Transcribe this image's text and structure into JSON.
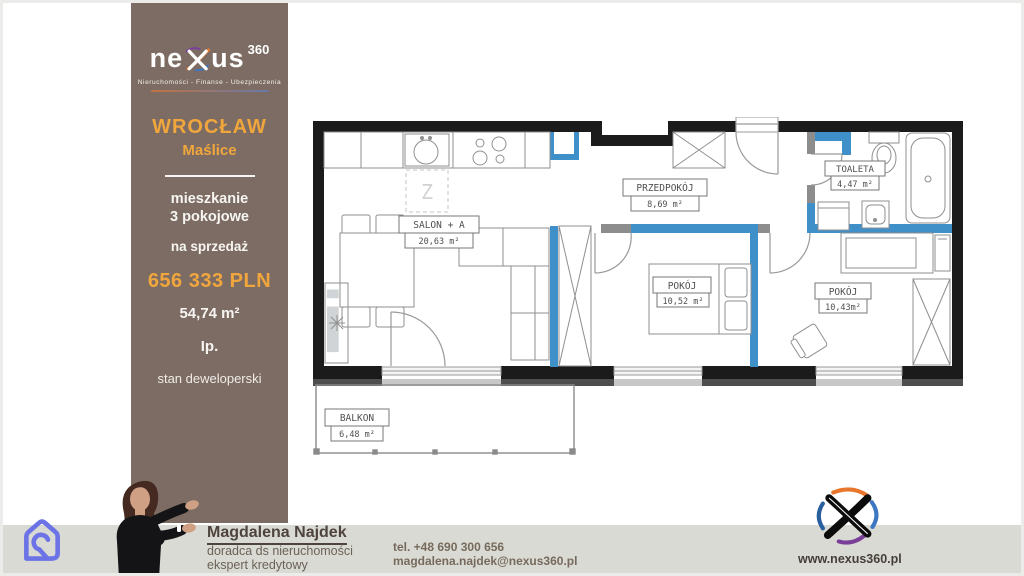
{
  "sidebar": {
    "logo": {
      "word_left": "ne",
      "word_right": "us",
      "sup": "360",
      "tagline": "Nieruchomości - Finanse - Ubezpieczenia"
    },
    "city": "WROCŁAW",
    "district": "Maślice",
    "type_line1": "mieszkanie",
    "type_line2": "3 pokojowe",
    "offer": "na sprzedaż",
    "price": "656 333 PLN",
    "area": "54,74 m²",
    "floor": "Ip.",
    "condition": "stan deweloperski"
  },
  "plan": {
    "rooms": {
      "salon": {
        "name": "SALON + A",
        "area": "20,63 m²"
      },
      "hall": {
        "name": "PRZEDPOKÓJ",
        "area": "8,69 m²"
      },
      "toilet": {
        "name": "TOALETA",
        "area": "4,47 m²"
      },
      "room1": {
        "name": "POKÓJ",
        "area": "10,52 m²"
      },
      "room2": {
        "name": "POKÓJ",
        "area": "10,43m²"
      },
      "balcony": {
        "name": "BALKON",
        "area": "6,48 m²"
      }
    },
    "marker_z": "Z",
    "watermark": "li"
  },
  "footer": {
    "agent_name": "Magdalena Najdek",
    "agent_role1": "doradca ds nieruchomości",
    "agent_role2": "ekspert kredytowy",
    "phone": "tel. +48 690 300 656",
    "email": "magdalena.najdek@nexus360.pl",
    "website": "www.nexus360.pl"
  },
  "colors": {
    "panel_brown": "#7d6c64",
    "accent_orange": "#f0a63c",
    "wall_black": "#1b1b1b",
    "glazing_blue": "#3f8fc9",
    "bar_gray": "#d8dad3",
    "portal_icon_blue": "#6b73e6"
  }
}
